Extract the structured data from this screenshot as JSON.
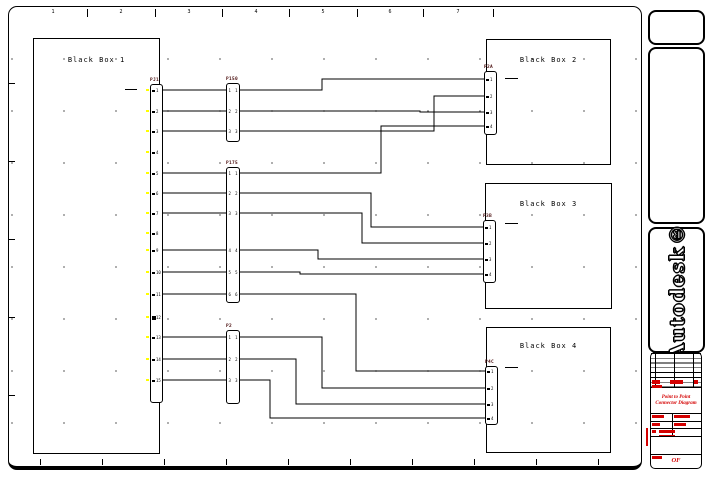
{
  "sheet": {
    "ruler_labels": [
      "1",
      "2",
      "3",
      "4",
      "5",
      "6",
      "7"
    ]
  },
  "boxes": [
    {
      "label": "Black Box 1"
    },
    {
      "label": "Black Box 2"
    },
    {
      "label": "Black Box 3"
    },
    {
      "label": "Black Box 4"
    }
  ],
  "connectors": {
    "pj1": {
      "label": "PJ1",
      "pins": [
        "1",
        "2",
        "3",
        "4",
        "5",
        "6",
        "7",
        "8",
        "9",
        "10",
        "11",
        "12",
        "13",
        "14",
        "15"
      ]
    },
    "p150": {
      "label": "P150",
      "pins": [
        "1",
        "2",
        "3"
      ]
    },
    "p175": {
      "label": "P175",
      "pins": [
        "1",
        "2",
        "3",
        "4",
        "5",
        "6"
      ]
    },
    "p2": {
      "label": "P2",
      "pins": [
        "1",
        "2",
        "3"
      ]
    },
    "p2a": {
      "label": "P2A",
      "pins": [
        "1",
        "2",
        "3",
        "4"
      ]
    },
    "p3b": {
      "label": "P3B",
      "pins": [
        "1",
        "2",
        "3",
        "4"
      ]
    },
    "p4c": {
      "label": "P4C",
      "pins": [
        "1",
        "2",
        "3",
        "4"
      ]
    }
  },
  "branding": {
    "logo_text": "Autodesk®"
  },
  "title_block": {
    "drawing_title_line1": "Point to Point",
    "drawing_title_line2": "Connector Diagram",
    "sheet_of_label": "OF"
  },
  "colors": {
    "line": "#000000",
    "accent_red": "#d40000",
    "connector_label": "#4a0d0d",
    "pin_highlight": "#ffff00"
  }
}
